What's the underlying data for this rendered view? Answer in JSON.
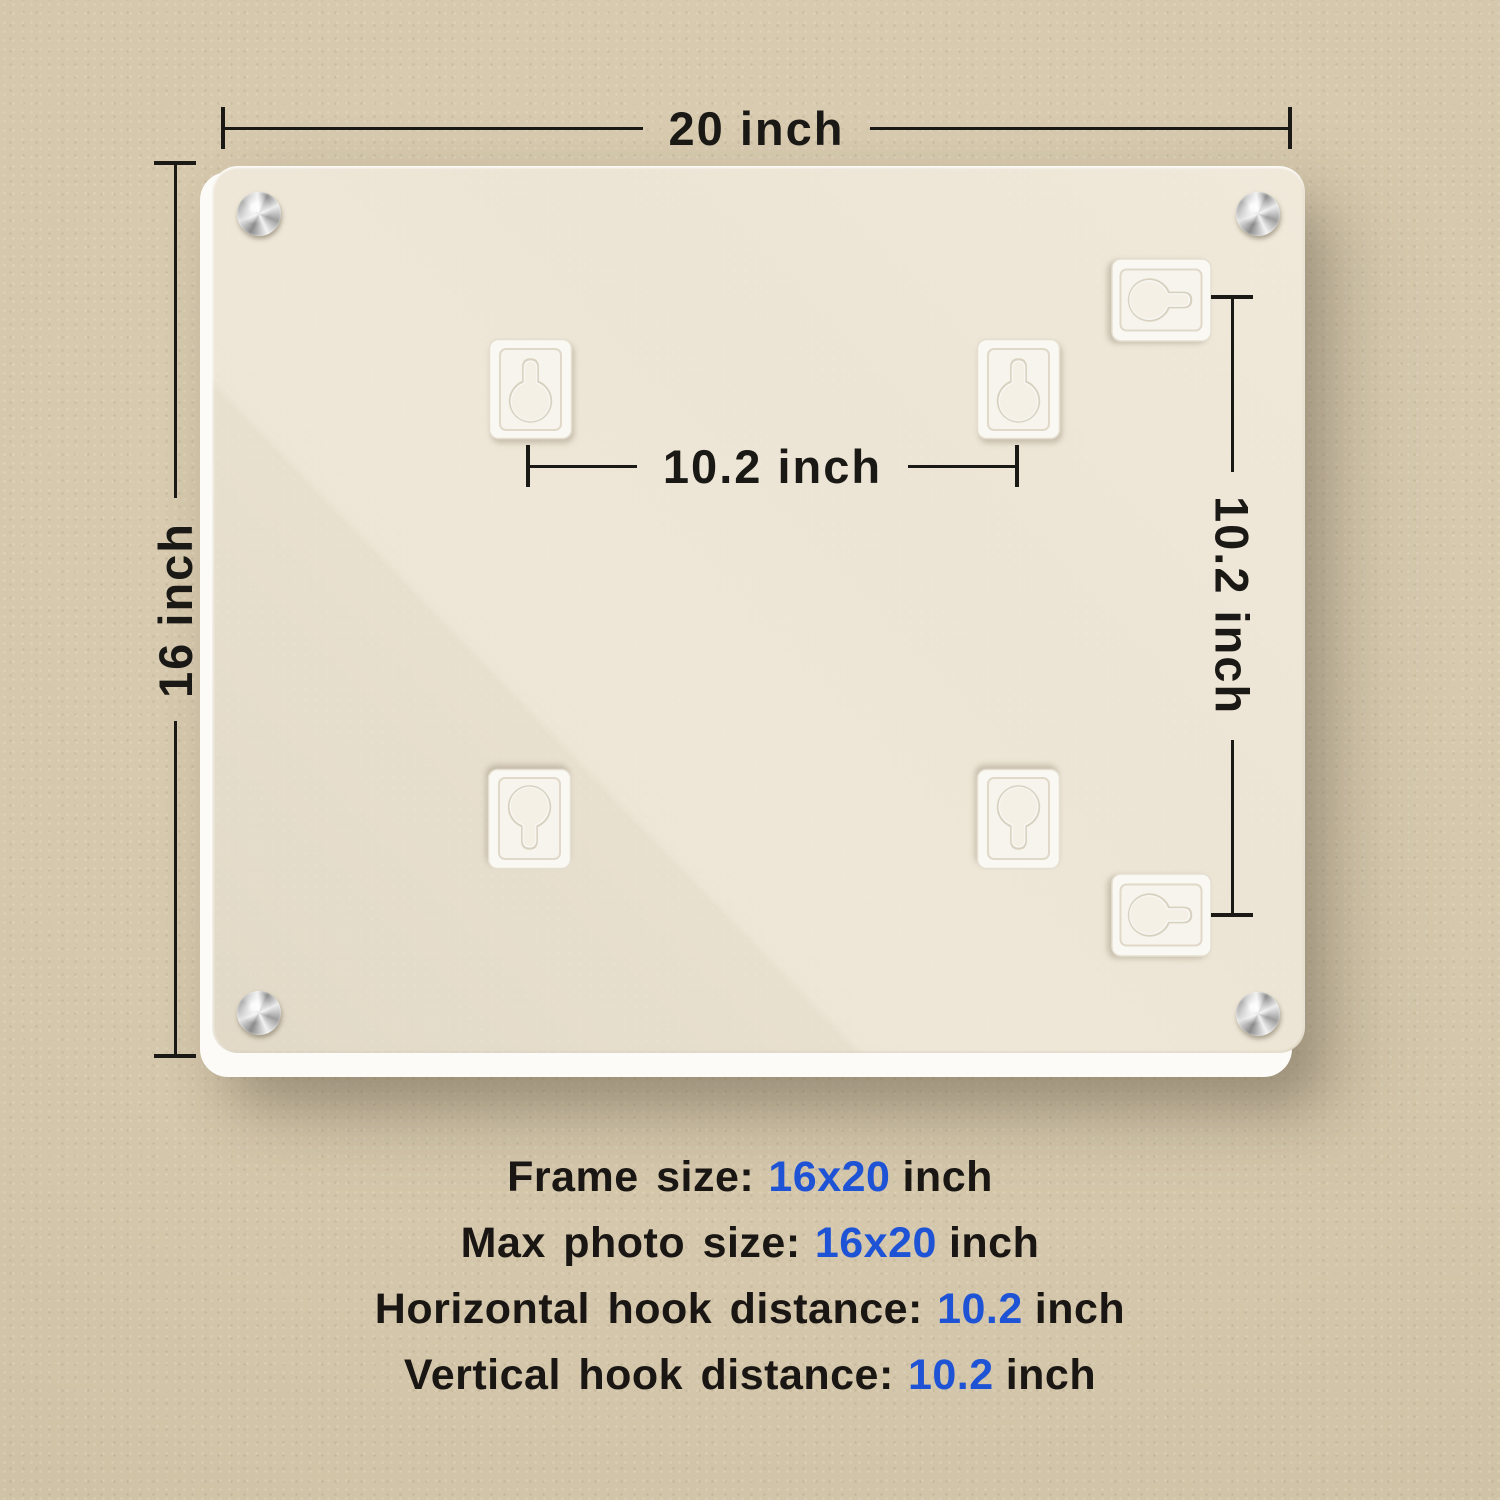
{
  "product_view": "picture-frame-back-panel",
  "colors": {
    "background": "#d5c7ab",
    "panel": "#ece4d4",
    "base_layer": "#fcfbf7",
    "ink": "#1b1916",
    "accent_blue": "#1e53d6",
    "hanger_white": "#faf8f3",
    "screw_silver": "#c9c9c9"
  },
  "dimensions": {
    "top_width": {
      "label": "20 inch"
    },
    "left_height": {
      "label": "16 inch"
    },
    "hook_horizontal": {
      "label": "10.2 inch"
    },
    "hook_vertical": {
      "label": "10.2 inch"
    }
  },
  "hardware": {
    "screw_icon": "corner-screw",
    "screw_count": 4,
    "hanger_icon": "keyhole-hanger",
    "hanger_count": 6
  },
  "specs": [
    {
      "prefix": "Frame size:",
      "value": "16x20",
      "suffix": "inch"
    },
    {
      "prefix": "Max photo size:",
      "value": "16x20",
      "suffix": "inch"
    },
    {
      "prefix": "Horizontal hook distance:",
      "value": "10.2",
      "suffix": "inch"
    },
    {
      "prefix": "Vertical hook distance:",
      "value": "10.2",
      "suffix": "inch"
    }
  ]
}
